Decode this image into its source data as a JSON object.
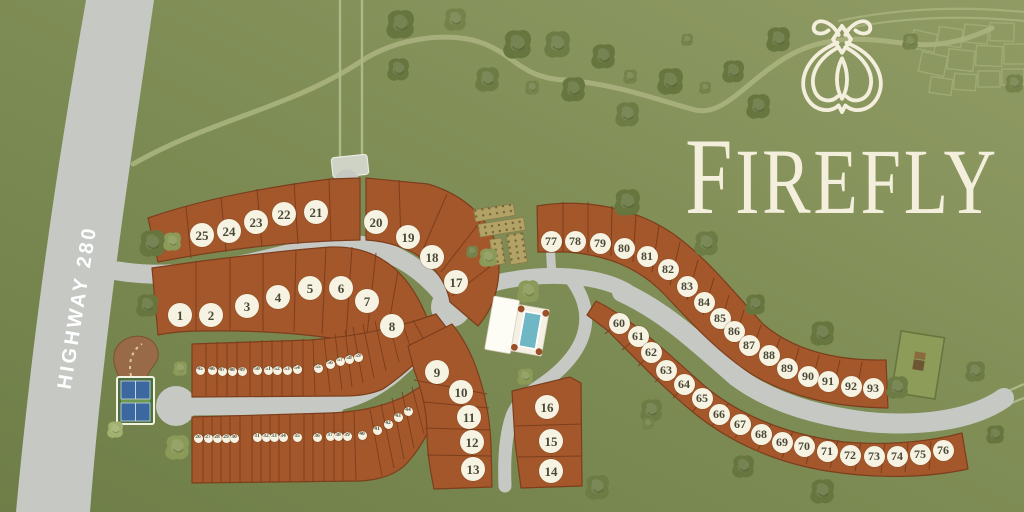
{
  "logo": {
    "title": "FIREFLY",
    "icon": "firefly-icon"
  },
  "highway": {
    "label": "HIGHWAY 280"
  },
  "colors": {
    "background_green": "#7c8b53",
    "background_green_light": "#8d9961",
    "road_gray": "#c6c8c4",
    "lot_rust": "#a4572a",
    "lot_border": "#7c3e1d",
    "circle_fill": "#f7f3e3",
    "circle_text": "#4a4936",
    "logo_cream": "#f3efdc",
    "tree_olive": "#67753f",
    "pool_blue": "#6fb7c4",
    "court_blue": "#3c68a0"
  },
  "amenities": [
    {
      "name": "pool-clubhouse"
    },
    {
      "name": "pickleball-courts"
    },
    {
      "name": "community-gardens"
    },
    {
      "name": "neighborhood-park"
    },
    {
      "name": "trailhead"
    }
  ],
  "lot_groups": [
    {
      "name": "estate-lots-south",
      "size": 24,
      "font": 13,
      "lots": [
        {
          "n": "1",
          "x": 180,
          "y": 315
        },
        {
          "n": "2",
          "x": 211,
          "y": 315
        },
        {
          "n": "3",
          "x": 247,
          "y": 306
        },
        {
          "n": "4",
          "x": 278,
          "y": 297
        },
        {
          "n": "5",
          "x": 310,
          "y": 288
        },
        {
          "n": "6",
          "x": 341,
          "y": 288
        },
        {
          "n": "7",
          "x": 367,
          "y": 301
        },
        {
          "n": "8",
          "x": 392,
          "y": 326
        }
      ]
    },
    {
      "name": "cottage-lots-center",
      "size": 24,
      "font": 13,
      "lots": [
        {
          "n": "9",
          "x": 437,
          "y": 372
        },
        {
          "n": "10",
          "x": 461,
          "y": 392
        },
        {
          "n": "11",
          "x": 469,
          "y": 417
        },
        {
          "n": "12",
          "x": 472,
          "y": 442
        },
        {
          "n": "13",
          "x": 473,
          "y": 469
        },
        {
          "n": "14",
          "x": 551,
          "y": 471
        },
        {
          "n": "15",
          "x": 551,
          "y": 441
        },
        {
          "n": "16",
          "x": 547,
          "y": 407
        }
      ]
    },
    {
      "name": "estate-lots-north",
      "size": 24,
      "font": 13,
      "lots": [
        {
          "n": "17",
          "x": 456,
          "y": 282
        },
        {
          "n": "18",
          "x": 432,
          "y": 257
        },
        {
          "n": "19",
          "x": 408,
          "y": 237
        },
        {
          "n": "20",
          "x": 376,
          "y": 222
        },
        {
          "n": "21",
          "x": 316,
          "y": 212
        },
        {
          "n": "22",
          "x": 284,
          "y": 214
        },
        {
          "n": "23",
          "x": 256,
          "y": 222
        },
        {
          "n": "24",
          "x": 229,
          "y": 231
        },
        {
          "n": "25",
          "x": 202,
          "y": 235
        }
      ]
    },
    {
      "name": "townhome-lots-lower-row",
      "size": 9,
      "font": 5.5,
      "lots": [
        {
          "n": "26",
          "x": 198,
          "y": 438
        },
        {
          "n": "27",
          "x": 208,
          "y": 438
        },
        {
          "n": "28",
          "x": 217,
          "y": 438
        },
        {
          "n": "29",
          "x": 226,
          "y": 438
        },
        {
          "n": "30",
          "x": 234,
          "y": 438
        },
        {
          "n": "31",
          "x": 257,
          "y": 437
        },
        {
          "n": "32",
          "x": 266,
          "y": 437
        },
        {
          "n": "33",
          "x": 274,
          "y": 437
        },
        {
          "n": "34",
          "x": 283,
          "y": 437
        },
        {
          "n": "35",
          "x": 297,
          "y": 437
        },
        {
          "n": "36",
          "x": 317,
          "y": 437
        },
        {
          "n": "37",
          "x": 330,
          "y": 436
        },
        {
          "n": "38",
          "x": 338,
          "y": 436
        },
        {
          "n": "39",
          "x": 347,
          "y": 436
        },
        {
          "n": "40",
          "x": 362,
          "y": 435
        },
        {
          "n": "41",
          "x": 377,
          "y": 430
        },
        {
          "n": "42",
          "x": 388,
          "y": 424
        },
        {
          "n": "43",
          "x": 398,
          "y": 417
        },
        {
          "n": "44",
          "x": 408,
          "y": 411
        }
      ]
    },
    {
      "name": "townhome-lots-upper-row",
      "size": 9,
      "font": 5.5,
      "lots": [
        {
          "n": "45",
          "x": 200,
          "y": 370
        },
        {
          "n": "46",
          "x": 212,
          "y": 370
        },
        {
          "n": "47",
          "x": 222,
          "y": 371
        },
        {
          "n": "48",
          "x": 232,
          "y": 371
        },
        {
          "n": "49",
          "x": 242,
          "y": 371
        },
        {
          "n": "50",
          "x": 257,
          "y": 370
        },
        {
          "n": "51",
          "x": 268,
          "y": 370
        },
        {
          "n": "52",
          "x": 277,
          "y": 370
        },
        {
          "n": "53",
          "x": 287,
          "y": 370
        },
        {
          "n": "54",
          "x": 297,
          "y": 369
        },
        {
          "n": "55",
          "x": 318,
          "y": 368
        },
        {
          "n": "56",
          "x": 330,
          "y": 364
        },
        {
          "n": "57",
          "x": 340,
          "y": 361
        },
        {
          "n": "58",
          "x": 349,
          "y": 359
        },
        {
          "n": "59",
          "x": 358,
          "y": 357
        }
      ]
    },
    {
      "name": "ridge-lots-inner-row",
      "size": 21,
      "font": 12,
      "lots": [
        {
          "n": "60",
          "x": 619,
          "y": 323
        },
        {
          "n": "61",
          "x": 638,
          "y": 336
        },
        {
          "n": "62",
          "x": 651,
          "y": 352
        },
        {
          "n": "63",
          "x": 666,
          "y": 370
        },
        {
          "n": "64",
          "x": 684,
          "y": 384
        },
        {
          "n": "65",
          "x": 702,
          "y": 398
        },
        {
          "n": "66",
          "x": 719,
          "y": 414
        },
        {
          "n": "67",
          "x": 740,
          "y": 424
        },
        {
          "n": "68",
          "x": 761,
          "y": 434
        },
        {
          "n": "69",
          "x": 782,
          "y": 442
        },
        {
          "n": "70",
          "x": 804,
          "y": 446
        },
        {
          "n": "71",
          "x": 827,
          "y": 451
        },
        {
          "n": "72",
          "x": 850,
          "y": 455
        },
        {
          "n": "73",
          "x": 874,
          "y": 456
        },
        {
          "n": "74",
          "x": 897,
          "y": 456
        },
        {
          "n": "75",
          "x": 920,
          "y": 454
        },
        {
          "n": "76",
          "x": 943,
          "y": 450
        }
      ]
    },
    {
      "name": "ridge-lots-outer-row",
      "size": 21,
      "font": 12,
      "lots": [
        {
          "n": "77",
          "x": 551,
          "y": 241
        },
        {
          "n": "78",
          "x": 575,
          "y": 241
        },
        {
          "n": "79",
          "x": 600,
          "y": 243
        },
        {
          "n": "80",
          "x": 624,
          "y": 248
        },
        {
          "n": "81",
          "x": 647,
          "y": 256
        },
        {
          "n": "82",
          "x": 668,
          "y": 269
        },
        {
          "n": "83",
          "x": 687,
          "y": 286
        },
        {
          "n": "84",
          "x": 704,
          "y": 302
        },
        {
          "n": "85",
          "x": 720,
          "y": 318
        },
        {
          "n": "86",
          "x": 734,
          "y": 331
        },
        {
          "n": "87",
          "x": 749,
          "y": 345
        },
        {
          "n": "88",
          "x": 769,
          "y": 355
        },
        {
          "n": "89",
          "x": 787,
          "y": 368
        },
        {
          "n": "90",
          "x": 808,
          "y": 376
        },
        {
          "n": "91",
          "x": 828,
          "y": 381
        },
        {
          "n": "92",
          "x": 851,
          "y": 386
        },
        {
          "n": "93",
          "x": 873,
          "y": 388
        }
      ]
    }
  ]
}
